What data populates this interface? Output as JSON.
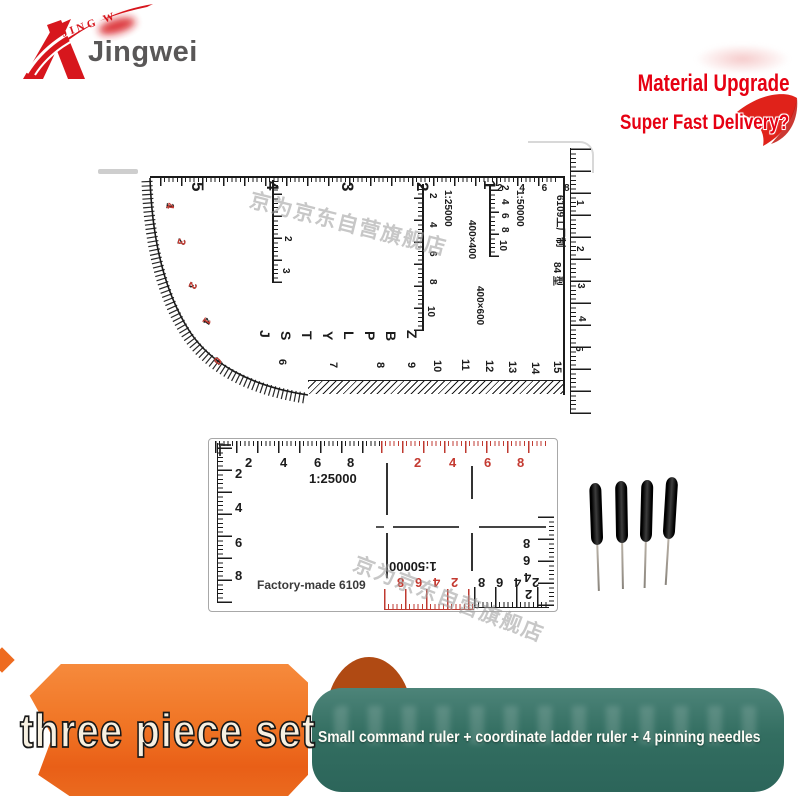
{
  "colors": {
    "brand_red": "#d7161d",
    "promo_red": "#e60012",
    "banner_orange": "#ef6c1f",
    "banner_teal": "#2f6b5e",
    "tick_red": "#bf3a30",
    "needle_black": "#111111"
  },
  "brand": {
    "arc_text": "JING W",
    "name": "Jingwei"
  },
  "promo": {
    "title": "Material Upgrade",
    "subtitle": "Super Fast Delivery?"
  },
  "watermark": {
    "text": "京为京东自营旗舰店"
  },
  "command_ruler": {
    "top_numbers": [
      {
        "t": "5",
        "x": 77,
        "y": 42
      },
      {
        "t": "4",
        "x": 152,
        "y": 41
      },
      {
        "t": "3",
        "x": 227,
        "y": 42
      },
      {
        "t": "2",
        "x": 302,
        "y": 42
      },
      {
        "t": "1",
        "x": 369,
        "y": 40
      }
    ],
    "top_small_numbers": "2 4 6 8",
    "curve_pairs": [
      {
        "black": "1",
        "red": "4",
        "x": 52,
        "y": 62,
        "r": 8
      },
      {
        "black": "2",
        "red": "3",
        "x": 64,
        "y": 97,
        "r": 16
      },
      {
        "black": "3",
        "red": "2",
        "x": 76,
        "y": 140,
        "r": 25
      },
      {
        "black": "4",
        "red": "1",
        "x": 91,
        "y": 175,
        "r": 34
      },
      {
        "black": "5",
        "red": "0",
        "x": 103,
        "y": 214,
        "r": 44
      }
    ],
    "arrow_scale_numbers": [
      {
        "t": "2",
        "x": 170,
        "y": 96
      },
      {
        "t": "3",
        "x": 168,
        "y": 128
      }
    ],
    "scale_25000": {
      "label": "1:25000",
      "size_label": "400×600",
      "numbers": [
        {
          "t": "2",
          "x": 315,
          "y": 53
        },
        {
          "t": "4",
          "x": 315,
          "y": 82
        },
        {
          "t": "6",
          "x": 315,
          "y": 111
        },
        {
          "t": "8",
          "x": 315,
          "y": 139
        },
        {
          "t": "10",
          "x": 313,
          "y": 166
        }
      ]
    },
    "scale_50000": {
      "label": "1:50000",
      "size_label": "400×400",
      "numbers": [
        {
          "t": "2",
          "x": 387,
          "y": 45
        },
        {
          "t": "4",
          "x": 387,
          "y": 59
        },
        {
          "t": "6",
          "x": 387,
          "y": 73
        },
        {
          "t": "8",
          "x": 387,
          "y": 87
        },
        {
          "t": "10",
          "x": 385,
          "y": 100
        }
      ]
    },
    "letters": [
      {
        "t": "J",
        "x": 146,
        "y": 190
      },
      {
        "t": "S",
        "x": 167,
        "y": 191
      },
      {
        "t": "T",
        "x": 188,
        "y": 191
      },
      {
        "t": "Y",
        "x": 209,
        "y": 191
      },
      {
        "t": "L",
        "x": 230,
        "y": 191
      },
      {
        "t": "P",
        "x": 251,
        "y": 191
      },
      {
        "t": "B",
        "x": 272,
        "y": 191
      },
      {
        "t": "Z",
        "x": 293,
        "y": 190
      }
    ],
    "bottom_numbers": [
      {
        "t": "6",
        "x": 164,
        "y": 219
      },
      {
        "t": "7",
        "x": 215,
        "y": 222
      },
      {
        "t": "8",
        "x": 262,
        "y": 222
      },
      {
        "t": "9",
        "x": 293,
        "y": 222
      },
      {
        "t": "10",
        "x": 319,
        "y": 220
      },
      {
        "t": "11",
        "x": 347,
        "y": 219
      },
      {
        "t": "12",
        "x": 371,
        "y": 220
      },
      {
        "t": "13",
        "x": 394,
        "y": 221
      },
      {
        "t": "14",
        "x": 417,
        "y": 222
      },
      {
        "t": "15",
        "x": 439,
        "y": 221
      }
    ],
    "right_label_top": "6109工厂制",
    "right_label_bottom": "84 型",
    "edge_numbers": [
      {
        "t": "1",
        "x": 462,
        "y": 60
      },
      {
        "t": "2",
        "x": 462,
        "y": 106
      },
      {
        "t": "3",
        "x": 463,
        "y": 143
      },
      {
        "t": "4",
        "x": 464,
        "y": 176
      },
      {
        "t": "5",
        "x": 461,
        "y": 206
      }
    ]
  },
  "coordinate_ruler": {
    "scale_label": "1:25000",
    "scale_label_bottom": "1:50000",
    "factory_label": "Factory-made 6109",
    "top_black_numbers": [
      {
        "t": "2",
        "x": 36,
        "y": 17
      },
      {
        "t": "4",
        "x": 71,
        "y": 17
      },
      {
        "t": "6",
        "x": 105,
        "y": 17
      },
      {
        "t": "8",
        "x": 138,
        "y": 17
      }
    ],
    "top_red_numbers": [
      {
        "t": "2",
        "x": 205,
        "y": 17
      },
      {
        "t": "4",
        "x": 240,
        "y": 17
      },
      {
        "t": "6",
        "x": 275,
        "y": 17
      },
      {
        "t": "8",
        "x": 308,
        "y": 17
      }
    ],
    "left_numbers": [
      {
        "t": "2",
        "x": 26,
        "y": 28
      },
      {
        "t": "4",
        "x": 26,
        "y": 62
      },
      {
        "t": "6",
        "x": 26,
        "y": 97
      },
      {
        "t": "8",
        "x": 26,
        "y": 130
      }
    ],
    "bottom_red_numbers": [
      {
        "t": "8",
        "x": 188,
        "y": 137,
        "r": 180
      },
      {
        "t": "6",
        "x": 206,
        "y": 137,
        "r": 180
      },
      {
        "t": "4",
        "x": 224,
        "y": 137,
        "r": 180
      },
      {
        "t": "2",
        "x": 242,
        "y": 137,
        "r": 180
      }
    ],
    "bottom_black_numbers": [
      {
        "t": "8",
        "x": 269,
        "y": 137,
        "r": 180
      },
      {
        "t": "6",
        "x": 287,
        "y": 137,
        "r": 180
      },
      {
        "t": "4",
        "x": 305,
        "y": 137,
        "r": 180
      },
      {
        "t": "2",
        "x": 323,
        "y": 137,
        "r": 180
      }
    ],
    "right_numbers": [
      {
        "t": "8",
        "x": 314,
        "y": 98,
        "r": 180
      },
      {
        "t": "6",
        "x": 314,
        "y": 115,
        "r": 180
      },
      {
        "t": "4",
        "x": 315,
        "y": 132,
        "r": 180
      },
      {
        "t": "2",
        "x": 316,
        "y": 149,
        "r": 180
      }
    ]
  },
  "needles": {
    "count": "4"
  },
  "banner": {
    "title": "three piece set",
    "subtitle": "Small command ruler + coordinate ladder ruler + 4 pinning needles"
  }
}
